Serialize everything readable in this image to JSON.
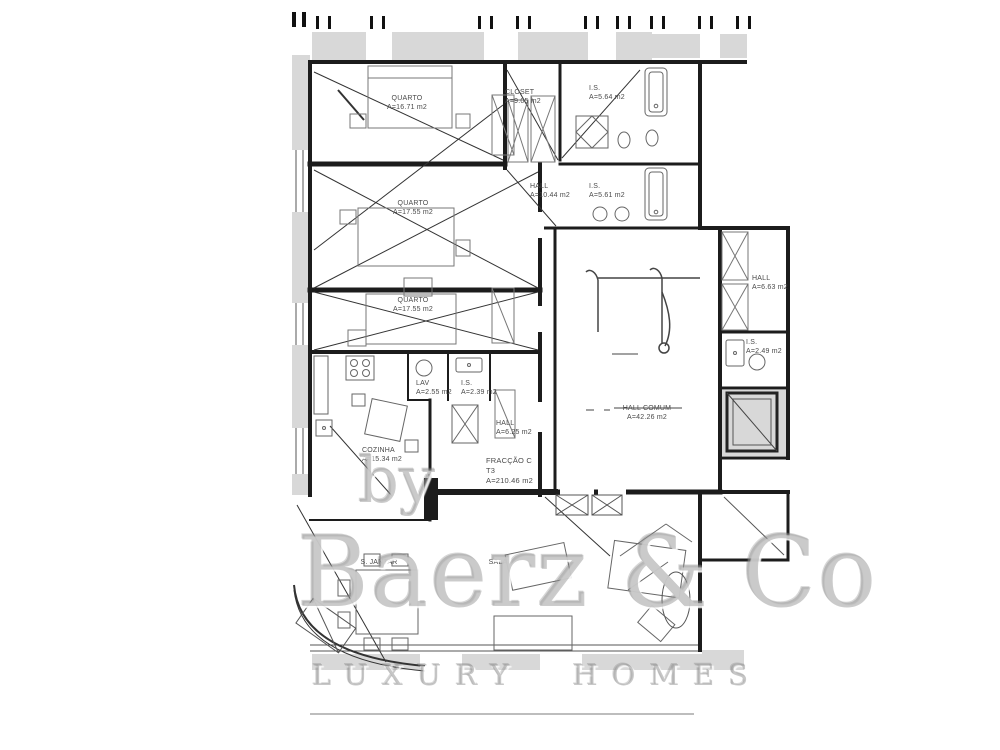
{
  "document_title": "Apartment floor plan - Fracção C (T3)",
  "palette": {
    "wall": "#1c1c1c",
    "thin_line": "#555555",
    "furniture_line": "#777777",
    "shading": "#d8d8d8",
    "label_text": "#4a4a4a",
    "watermark": "#949494"
  },
  "unit": {
    "name": "FRACÇÃO C",
    "type": "T3",
    "area": "A=210.46 m2"
  },
  "rooms": [
    {
      "name": "QUARTO",
      "area": "A=16.71 m2"
    },
    {
      "name": "QUARTO",
      "area": "A=17.55 m2"
    },
    {
      "name": "QUARTO",
      "area": "A=17.55 m2"
    },
    {
      "name": "CLOSET",
      "area": "A=9.05 m2"
    },
    {
      "name": "I.S.",
      "area": "A=5.64 m2"
    },
    {
      "name": "HALL",
      "area": "A=10.44 m2"
    },
    {
      "name": "I.S.",
      "area": "A=5.61 m2"
    },
    {
      "name": "HALL",
      "area": "A=6.63 m2"
    },
    {
      "name": "I.S.",
      "area": "A=2.49 m2"
    },
    {
      "name": "HALL COMUM",
      "area": "A=42.26 m2"
    },
    {
      "name": "LAV",
      "area": "A=2.55 m2"
    },
    {
      "name": "I.S.",
      "area": "A=2.39 m2"
    },
    {
      "name": "HALL",
      "area": "A=6.25 m2"
    },
    {
      "name": "COZINHA",
      "area": "A=15.34 m2"
    },
    {
      "name": "S. JANTAR",
      "area": ""
    },
    {
      "name": "SALA",
      "area": ""
    }
  ],
  "watermark": {
    "by": "by",
    "brand": "Baerz & Co",
    "tagline": "LUXURY HOMES"
  }
}
